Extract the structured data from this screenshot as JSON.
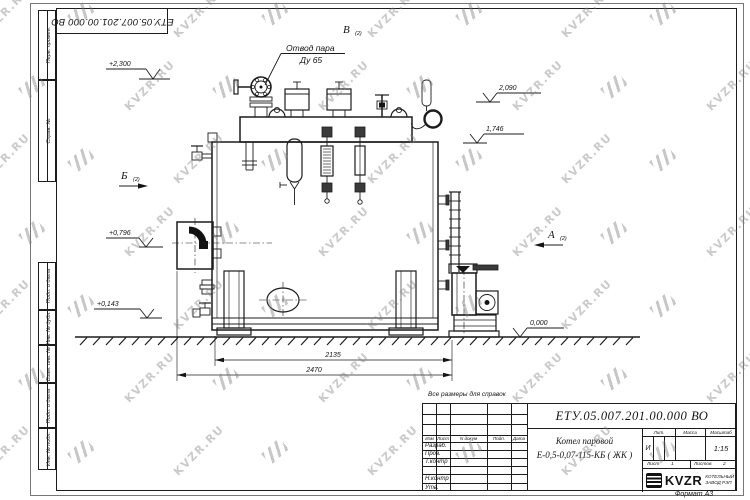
{
  "watermark": {
    "text": "KVZR.RU"
  },
  "frame": {
    "left_margin_labels": [
      "Перв. примен.",
      "Справ. №",
      "Подп. и дата",
      "Инв. № дубл.",
      "Взам. инв. №",
      "Подп. и дата",
      "Инв. № подл."
    ],
    "format_note": "Формат А3"
  },
  "drawing": {
    "callout_line1": "Отвод пара",
    "callout_line2": "Ду 65",
    "view_v": "В",
    "view_b": "Б",
    "view_a": "А",
    "sheet_ref": "(2)",
    "elev_2300": "+2,300",
    "elev_2090": "2,090",
    "elev_1746": "1,746",
    "elev_0796": "+0,796",
    "elev_0143": "+0,143",
    "elev_0000": "0,000",
    "dim_2135": "2135",
    "dim_2470": "2470",
    "note": "Все размеры для справок"
  },
  "title_block": {
    "doc_number": "ЕТУ.05.007.201.00.000  ВО",
    "name_line1": "Котел паровой",
    "name_line2": "Е-0,5-0,07-115-КБ ( ЖК )",
    "col_izm": "Изм",
    "col_list": "Лист",
    "col_ndocum": "N докум",
    "col_podp": "Подп.",
    "col_data": "Дата",
    "row_razrab": "Разраб.",
    "row_prov": "Пров.",
    "row_tkontr": "Т.контр",
    "row_nkontr": "Н.контр",
    "row_utv": "Утв.",
    "lit_label": "Лит.",
    "massa_label": "Масса",
    "masshtab_label": "Масштаб",
    "lit_value": "И",
    "scale_value": "1:15",
    "sheet_label": "Лист",
    "sheet_value": "1",
    "sheets_label": "Листов",
    "sheets_value": "2",
    "logo_text": "KVZR",
    "logo_sub1": "КОТЕЛЬНЫЙ",
    "logo_sub2": "ЗАВОД РЭП"
  }
}
